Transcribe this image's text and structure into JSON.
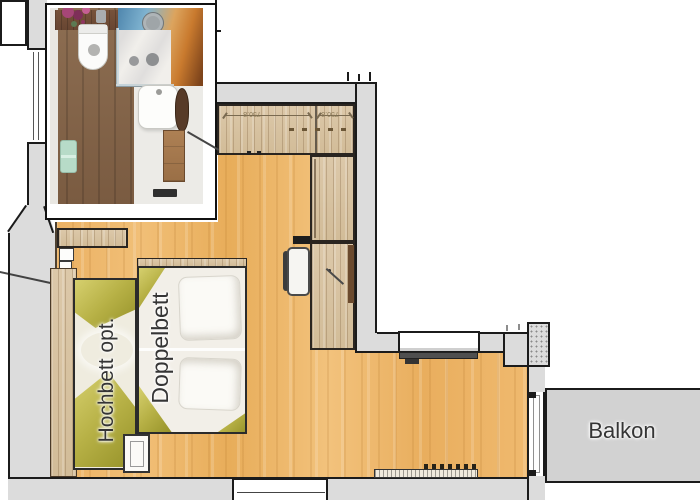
{
  "plan": {
    "labels": {
      "hochbett": "Hochbett opt.",
      "doppelbett": "Doppelbett",
      "balkon": "Balkon"
    },
    "dims": {
      "closet_left": "750.8",
      "closet_right": "750.8"
    },
    "colors": {
      "wall_gray": "#dcdcdc",
      "floor_orange": "#ecb264",
      "wood_light": "#d9c6a8",
      "bath_floor_brown": "#87684c",
      "bed_white": "#f2efe8",
      "bed_olive": "#b7b146",
      "balcony_gray": "#d2d2d2",
      "outline_black": "#1b1b1b",
      "mural_blue": "#74a3c2",
      "mural_orange": "#d99a4a",
      "towel_mint": "#b7dbc8"
    }
  }
}
